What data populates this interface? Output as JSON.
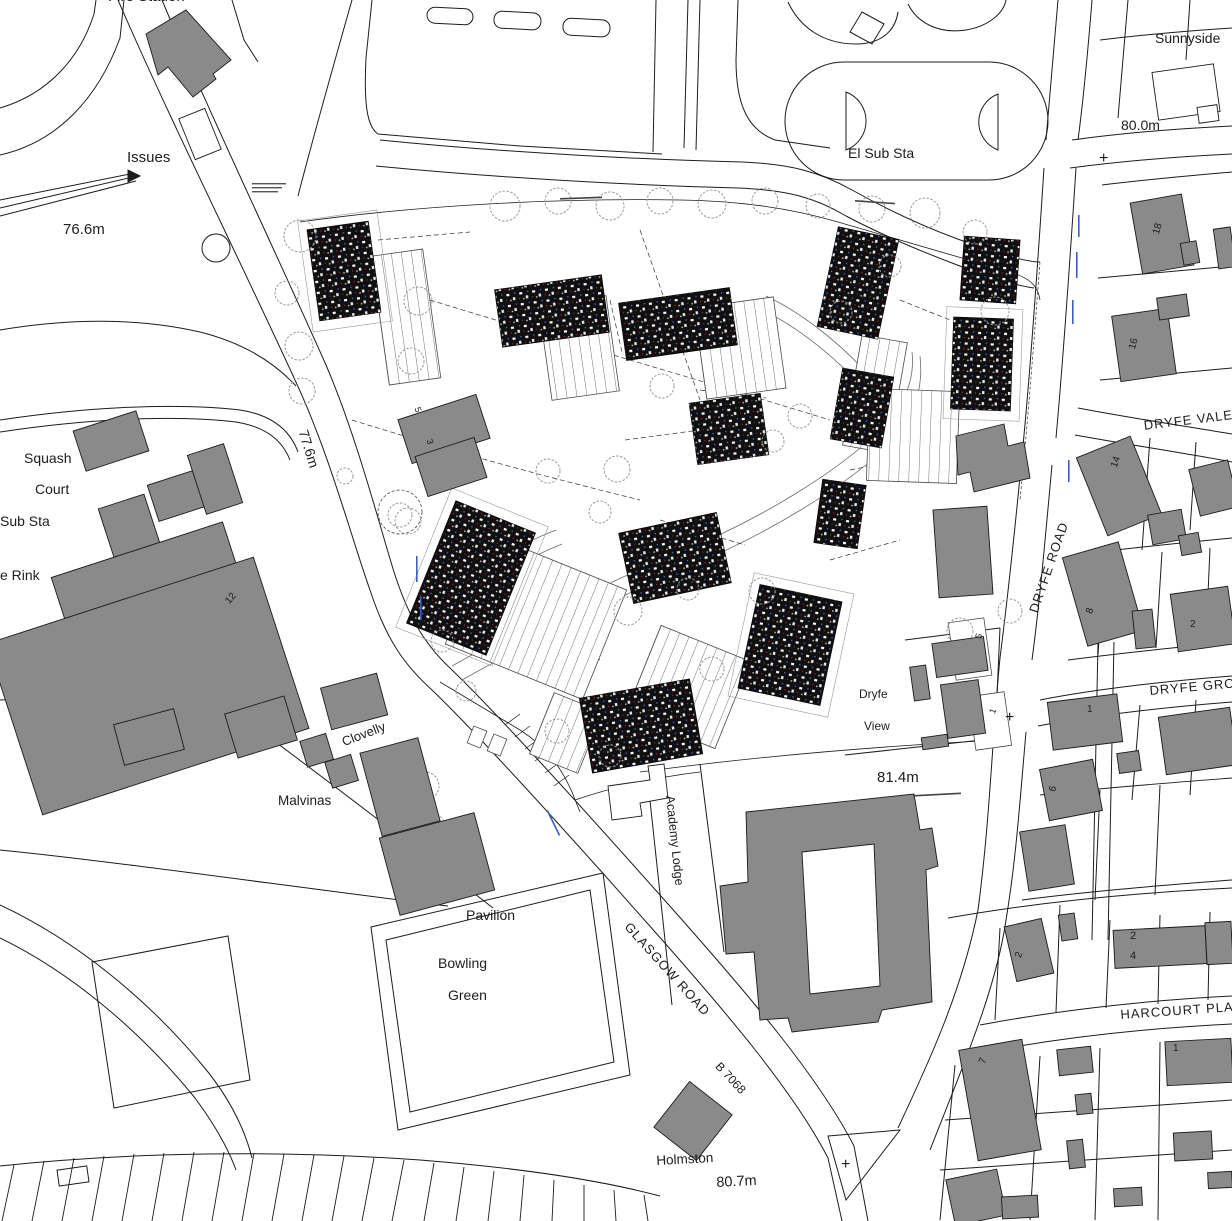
{
  "labels": {
    "fire_station": "Fire Station",
    "issues": "Issues",
    "spot_76_6": "76.6m",
    "el_sub_sta": "El Sub Sta",
    "sunnyside": "Sunnyside",
    "spot_80_0": "80.0m",
    "house_18": "18",
    "house_16": "16",
    "street_dryfe_vale": "DRYFE VALE",
    "street_dryfe_road": "DRYFE ROAD",
    "street_dryfe_grove": "DRYFE GROVE",
    "house_14": "14",
    "house_8": "8",
    "house_2_dryfe_vale": "2",
    "house_1_dryfe_grove": "1",
    "house_6": "6",
    "plot_5_site": "5",
    "plot_1_site": "1",
    "dryfe_view_line1": "Dryfe",
    "dryfe_view_line2": "View",
    "spot_81_4": "81.4m",
    "academy_lodge": "Academy Lodge",
    "squash": "Squash",
    "court": "Court",
    "sub_sta": "Sub Sta",
    "rink": "e Rink",
    "house_12": "12",
    "spot_77_6": "77.6m",
    "plot_5_west": "5",
    "plot_3_west": "3",
    "clovelly": "Clovelly",
    "malvinas": "Malvinas",
    "pavilion": "Pavilion",
    "bowling": "Bowling",
    "green": "Green",
    "street_glasgow_road": "GLASGOW ROAD",
    "road_b7068": "B 7068",
    "holmston": "Holmston",
    "spot_80_7": "80.7m",
    "street_harcourt_place": "HARCOURT PLACE",
    "house_7": "7",
    "house_2_harcourt_w": "2",
    "house_2_row": "2",
    "house_4_row": "4",
    "house_1_harcourt": "1",
    "cross_1": "+",
    "cross_2": "+",
    "cross_3": "+"
  },
  "colors": {
    "building_fill": "#8a8a8a",
    "line": "#1c1c1c",
    "tree_outline": "#9a9a9a",
    "dev_block": "#101010",
    "annotation_blue": "#3a5fc0"
  }
}
